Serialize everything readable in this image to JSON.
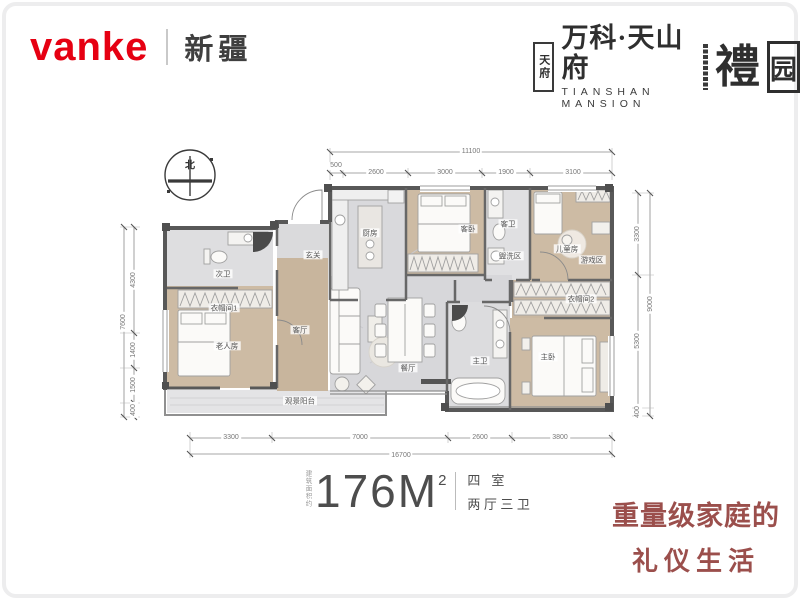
{
  "colors": {
    "brand_red": "#e60012",
    "logo_dark": "#2f2f2f",
    "tagline_red": "#9b4f4c",
    "wall_gray": "#585858",
    "wood_floor": "#cbb9a2",
    "marble_gray": "#d7d7da"
  },
  "header": {
    "logo_text": "vanke",
    "region": "新疆",
    "project": {
      "seal_text": "天府",
      "name_cn": "万科·天山府",
      "name_en": "TIANSHAN MANSION",
      "li_char": "禮",
      "yuan_char": "园"
    }
  },
  "floorplan": {
    "compass": "北",
    "dims": {
      "top_total": "11100",
      "top_segs": [
        "500",
        "2600",
        "3000",
        "1900",
        "3100"
      ],
      "bottom_segs": [
        "3300",
        "7000",
        "2600",
        "3800"
      ],
      "bottom_total": "16700",
      "left_segs": [
        "4300",
        "1400",
        "1500",
        "400"
      ],
      "left_total": "7600",
      "right_segs": [
        "3300",
        "5300",
        "400"
      ],
      "right_total": "9000"
    },
    "rooms": {
      "ciwei": "次卫",
      "yimaojian1": "衣帽间1",
      "laorenfang": "老人房",
      "yangtai": "观景阳台",
      "xuanguan": "玄关",
      "chufang": "厨房",
      "kewo": "客卧",
      "kewei": "客卫",
      "guanxiqu": "盥洗区",
      "ertongfang": "儿童房",
      "youxiqu": "游戏区",
      "yimaojian2": "衣帽间2",
      "zhuwei": "主卫",
      "zhuwo": "主卧",
      "keting": "客厅",
      "canting": "餐厅"
    }
  },
  "summary": {
    "area_note": "建筑面积约",
    "area_value": "176M",
    "area_sup": "2",
    "rooms_line1": "四室",
    "rooms_line2": "两厅三卫"
  },
  "tagline": {
    "line1": "重量级家庭的",
    "line2": "礼仪生活"
  }
}
